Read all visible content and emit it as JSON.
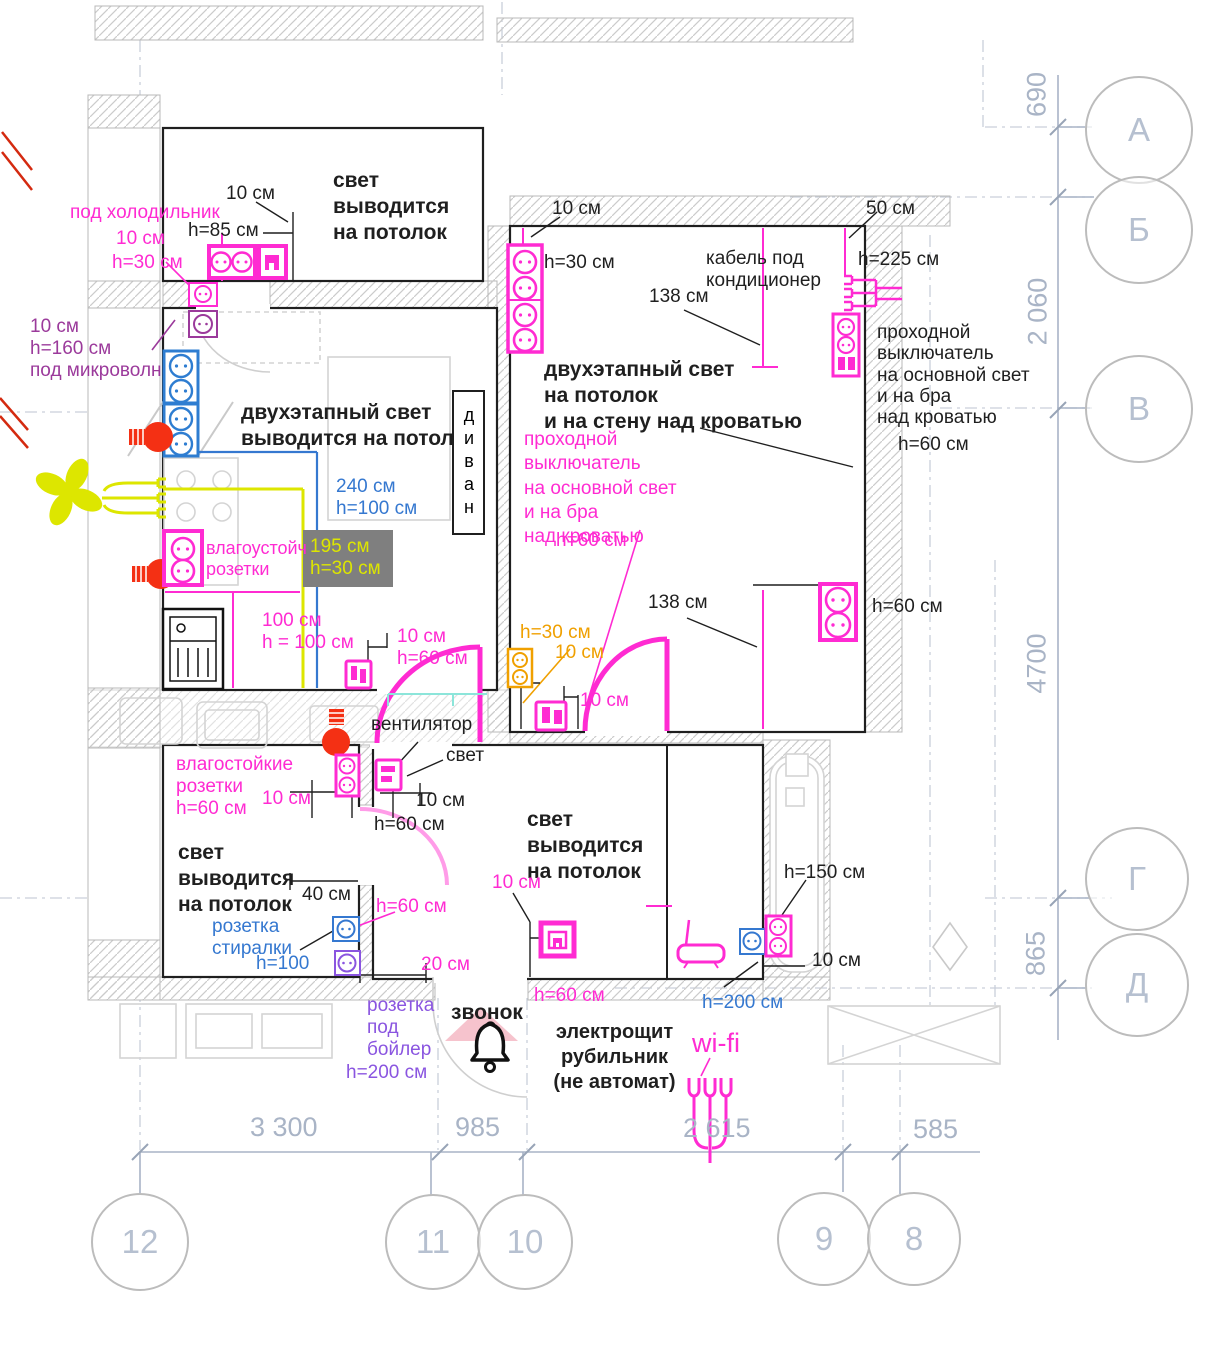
{
  "colors": {
    "magenta": "#ff2bd2",
    "pink_door": "#ff9ce8",
    "purple": "#9b3a9b",
    "violet": "#8a55e0",
    "blue": "#3578d0",
    "orange": "#f0a000",
    "yellow": "#dde600",
    "red_bulb": "#f43014",
    "black": "#1f1f1f",
    "gray_dim": "#a9b4c6",
    "gray_wall": "#b8b8b8",
    "teal": "#8ce5da",
    "highlight_box": "#7f7f7f"
  },
  "labels": {
    "fridge_note": "под холодильник",
    "fridge_d10": "10 см",
    "fridge_h30": "h=30 см",
    "top_d10": "10 см",
    "top_h85": "h=85 см",
    "top_room_light": "свет\nвыводится\nна потолок",
    "microwave_note": "10 см\nh=160 см\nпод микроволн",
    "kitchen_light": "двухэтапный свет\nвыводится на потолок",
    "divan": "диван",
    "dim240": "240 см\nh=100 см",
    "dim195": "195 см\nh=30 см",
    "kitchen_wet_sockets": "влагоустойч\nрозетки",
    "dim100": "100 см\nh = 100 см",
    "kitchen_d10h60": "10 см\nh=60 см",
    "bedroom_d10": "10 см",
    "bedroom_d50": "50 см",
    "bedroom_h30": "h=30 см",
    "ac_cable": "кабель под\nкондиционер",
    "bedroom_h225": "h=225 см",
    "bedroom_138_top": "138 см",
    "bedroom_light": "двухэтапный свет\nна потолок\nи на стену над кроватью",
    "pass_switch_black": "проходной\nвыключатель\nна основной свет\nи на бра\nнад кроватью",
    "pass_switch_black_h": "h=60 см",
    "pass_switch_magenta": "проходной\nвыключатель\nна основной свет\nи на бра\nнад кроватью",
    "pass_switch_magenta_h": "h=60 см",
    "door_h30_orange": "h=30 см",
    "door_d10_orange": "10 см",
    "bedroom_138_bottom": "138 см",
    "bedroom_h60_right": "h=60 см",
    "bedroom_door_d10": "10 см",
    "bath_sockets": "влагостойкие\nрозетки\nh=60 см",
    "bath_d10_m": "10 см",
    "bath_d10_b": "10 см",
    "bath_h60_b": "h=60 см",
    "bath_light": "свет\nвыводится\nна потолок",
    "bath_d40": "40 см",
    "bath_h60_m": "h=60 см",
    "washer_socket": "розетка\nстиралки",
    "washer_h": "h=100",
    "bath_d20": "20 см",
    "fan_label": "вентилятор",
    "light_label": "свет",
    "hall_light": "свет\nвыводится\nна потолок",
    "hall_d10": "10 см",
    "hall_h60": "h=60 см",
    "boiler_socket": "розетка\nпод\nбойлер",
    "boiler_h": "h=200 см",
    "bell": "звонок",
    "panel": "электрощит\nрубильник\n(не автомат)",
    "wifi": "wi-fi",
    "entry_h150": "h=150 см",
    "entry_d10": "10 см",
    "entry_h200": "h=200 см"
  },
  "axis": {
    "letters": [
      "А",
      "Б",
      "В",
      "Г",
      "Д"
    ],
    "numbers": [
      "12",
      "11",
      "10",
      "9",
      "8"
    ]
  },
  "dims": {
    "bottom": [
      "3 300",
      "985",
      "2 615",
      "585"
    ],
    "right": [
      "690",
      "2 060",
      "4700",
      "865"
    ]
  }
}
